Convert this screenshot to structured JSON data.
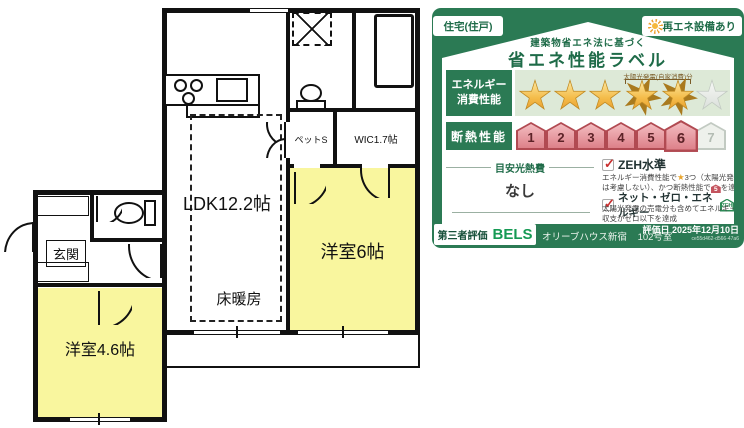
{
  "floor_plan": {
    "labels": {
      "ldk": "LDK12.2帖",
      "floor_heating": "床暖房",
      "western_room_6": "洋室6帖",
      "western_room_46": "洋室4.6帖",
      "wic": "WIC1.7帖",
      "pet_storage": "ペットS",
      "entrance": "玄関"
    },
    "colors": {
      "room_yellow": "#f9f69e",
      "fixture_cyan": "#3fdfe9",
      "line": "#111111"
    }
  },
  "energy_label": {
    "badge_housing": "住宅(住戸)",
    "badge_renewable": "再エネ設備あり",
    "title_small": "建築物省エネ法に基づく",
    "title_large": "省エネ性能ラベル",
    "energy_row": {
      "label_line1": "エネルギー",
      "label_line2": "消費性能",
      "solar_note": "太陽光発電(自家消費)分",
      "stars_filled": 3,
      "stars_solar": 2,
      "stars_empty": 1
    },
    "insulation_row": {
      "label": "断熱性能",
      "levels": [
        "1",
        "2",
        "3",
        "4",
        "5",
        "6",
        "7"
      ],
      "achieved_max": 6
    },
    "estimate": {
      "label": "目安光熱費",
      "value": "なし"
    },
    "zeh": {
      "item1_title": "ZEH水準",
      "item1_desc_a": "エネルギー消費性能で",
      "item1_desc_b": "3つ（太陽光発電",
      "item1_desc_c": "は考慮しない）、かつ断熱性能で",
      "item1_house_level": "5",
      "item1_desc_d": "を達成",
      "item2_title": "ネット・ゼロ・エネルギー",
      "item2_badge": "ZEH",
      "item2_desc_a": "太陽光発電の売電分も含めてエネルギー",
      "item2_desc_b": "収支がゼロ以下を達成"
    },
    "footer": {
      "third_party": "第三者評価",
      "brand": "BELS",
      "building": "オリーブハウス新宿",
      "room": "102号室",
      "date": "評価日 2025年12月10日",
      "cert_id": "ce55d462-d566-47a6"
    },
    "colors": {
      "green": "#2b7a54",
      "light_green": "#dde9d7",
      "star_gold": "#f4bc4a",
      "house_pink": "#dd8089"
    }
  }
}
